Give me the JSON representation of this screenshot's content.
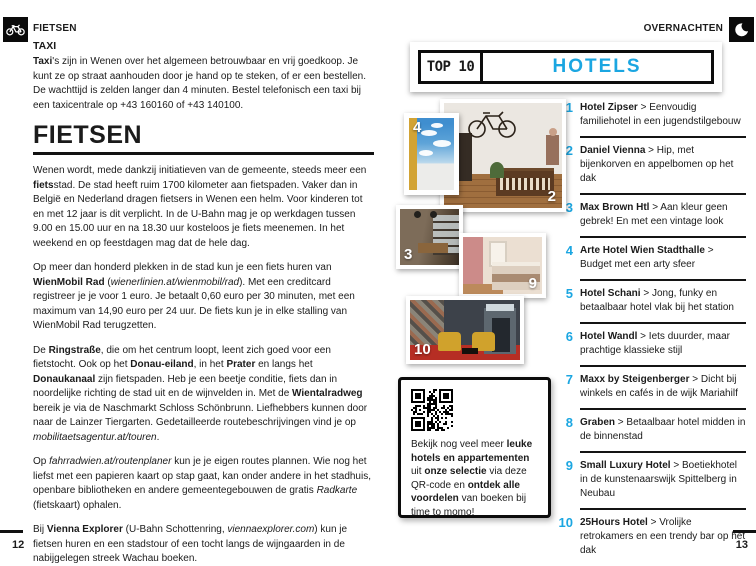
{
  "accent_color": "#1ba6e1",
  "text_color": "#1b1b1b",
  "left_page": {
    "section_label": "FIETSEN",
    "section_icon": "bicycle-icon",
    "taxi_heading": "TAXI",
    "taxi_paragraph": [
      {
        "t": "Taxi",
        "b": true
      },
      {
        "t": "'s zijn in Wenen over het algemeen betrouwbaar en vrij goedkoop. Je kunt ze op straat aanhouden door je hand op te steken, of er een bestellen. De wachttijd is zelden langer dan 4 minuten. Bestel telefonisch een taxi bij een taxicentrale op +43 160160 of +43 140100."
      }
    ],
    "title": "FIETSEN",
    "paragraphs": [
      [
        {
          "t": "Wenen wordt, mede dankzij initiatieven van de gemeente, steeds meer een "
        },
        {
          "t": "fiets",
          "b": true
        },
        {
          "t": "stad. De stad heeft ruim 1700 kilometer aan fietspaden. Vaker dan in België en Nederland dragen fietsers in Wenen een helm. Voor kinderen tot en met 12 jaar is dit verplicht. In de U-Bahn mag je op werkdagen tussen 9.00 en 15.00 uur en na 18.30 uur kosteloos je fiets meenemen. In het weekend en op feestdagen mag dat de hele dag."
        }
      ],
      [
        {
          "t": "Op meer dan honderd plekken in de stad kun je een fiets huren van "
        },
        {
          "t": "WienMobil Rad",
          "b": true
        },
        {
          "t": " ("
        },
        {
          "t": "wienerlinien.at/wienmobil/rad",
          "i": true
        },
        {
          "t": "). Met een creditcard registreer je je voor 1 euro. Je betaalt 0,60 euro per 30 minuten, met een maximum van 14,90 euro per 24 uur. De fiets kun je in elke stalling van WienMobil Rad terugzetten."
        }
      ],
      [
        {
          "t": "De "
        },
        {
          "t": "Ringstraße",
          "b": true
        },
        {
          "t": ", die om het centrum loopt, leent zich goed voor een fietstocht. Ook op het "
        },
        {
          "t": "Donau-eiland",
          "b": true
        },
        {
          "t": ", in het "
        },
        {
          "t": "Prater",
          "b": true
        },
        {
          "t": " en langs het "
        },
        {
          "t": "Donaukanaal",
          "b": true
        },
        {
          "t": " zijn fietspaden. Heb je een beetje conditie, fiets dan in noordelijke richting de stad uit en de wijnvelden in. Met de "
        },
        {
          "t": "Wientalradweg",
          "b": true
        },
        {
          "t": " bereik je via de Naschmarkt Schloss Schönbrunn. Liefhebbers kunnen door naar de Lainzer Tiergarten. Gedetailleerde routebeschrijvingen vind je op "
        },
        {
          "t": "mobilitaetsagentur.at/touren",
          "i": true
        },
        {
          "t": "."
        }
      ],
      [
        {
          "t": "Op "
        },
        {
          "t": "fahrradwien.at/routenplaner",
          "i": true
        },
        {
          "t": " kun je je eigen routes plannen. Wie nog het liefst met een papieren kaart op stap gaat, kan onder andere in het stadhuis, openbare bibliotheken en andere gemeentegebouwen de gratis "
        },
        {
          "t": "Radkarte",
          "i": true
        },
        {
          "t": " (fietskaart) ophalen."
        }
      ],
      [
        {
          "t": "Bij "
        },
        {
          "t": "Vienna Explorer",
          "b": true
        },
        {
          "t": " (U-Bahn Schottenring, "
        },
        {
          "t": "viennaexplorer.com",
          "i": true
        },
        {
          "t": ") kun je fietsen huren en een stadstour of een tocht langs de wijngaarden in de nabijgelegen streek Wachau boeken."
        }
      ]
    ],
    "page_number": "12"
  },
  "right_page": {
    "section_label": "OVERNACHTEN",
    "section_icon": "moon-icon",
    "top10": {
      "label": "TOP 10",
      "title": "HOTELS"
    },
    "photo_badges": [
      "4",
      "2",
      "3",
      "9",
      "10"
    ],
    "qr_note": [
      {
        "t": "Bekijk nog veel meer "
      },
      {
        "t": "leuke hotels en appartementen",
        "b": true
      },
      {
        "t": " uit "
      },
      {
        "t": "onze selectie",
        "b": true
      },
      {
        "t": " via deze QR-code en "
      },
      {
        "t": "ontdek alle voordelen",
        "b": true
      },
      {
        "t": " van boeken bij time to momo!"
      }
    ],
    "hotels": [
      {
        "rank": "1",
        "name": "Hotel Zipser",
        "desc": "> Eenvoudig familiehotel in een jugendstilgebouw"
      },
      {
        "rank": "2",
        "name": "Daniel Vienna",
        "desc": "> Hip, met bijenkorven en appelbomen op het dak"
      },
      {
        "rank": "3",
        "name": "Max Brown Htl",
        "desc": "> Aan kleur geen gebrek! En met een vintage look"
      },
      {
        "rank": "4",
        "name": "Arte Hotel Wien Stadthalle",
        "desc": "> Budget met een arty sfeer"
      },
      {
        "rank": "5",
        "name": "Hotel Schani",
        "desc": "> Jong, funky en betaalbaar hotel vlak bij het station"
      },
      {
        "rank": "6",
        "name": "Hotel Wandl",
        "desc": "> Iets duurder, maar prachtige klassieke stijl"
      },
      {
        "rank": "7",
        "name": "Maxx by Steigenberger",
        "desc": "> Dicht bij winkels en cafés in de wijk Mariahilf"
      },
      {
        "rank": "8",
        "name": "Graben",
        "desc": "> Betaalbaar hotel midden in de binnenstad"
      },
      {
        "rank": "9",
        "name": "Small Luxury Hotel",
        "desc": "> Boetiekhotel in de kunstenaarswijk Spittelberg in Neubau"
      },
      {
        "rank": "10",
        "name": "25Hours Hotel",
        "desc": "> Vrolijke retrokamers en een trendy bar op het dak"
      }
    ],
    "page_number": "13"
  }
}
